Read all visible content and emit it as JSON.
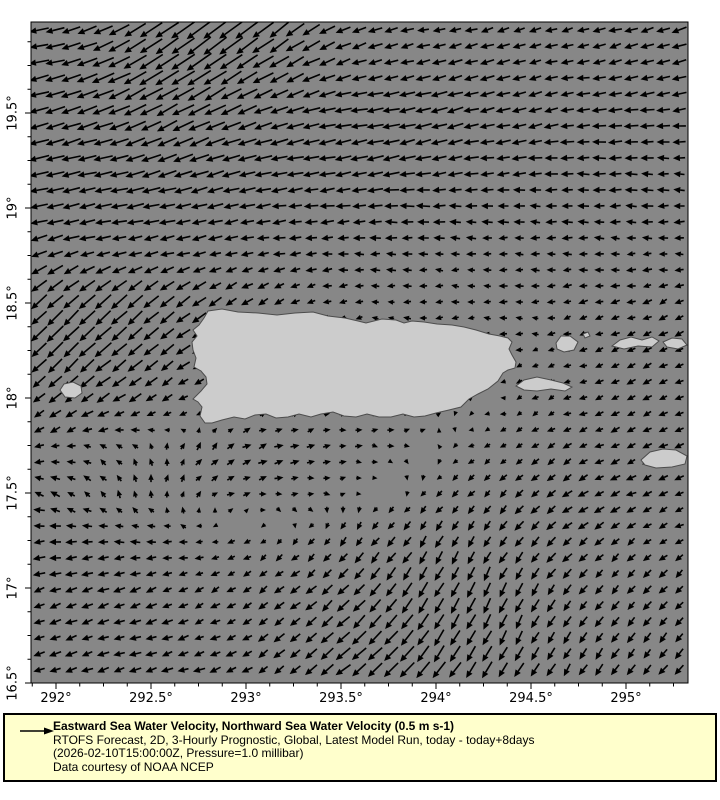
{
  "colors": {
    "page_bg": "#ffffff",
    "sea": "#878787",
    "land": "#cccccc",
    "land_outline": "#4d4d4d",
    "arrow": "#000000",
    "axis": "#000000",
    "legend_bg": "#ffffcc",
    "legend_border": "#000000"
  },
  "legend": {
    "reference_arrow_icon": "right-arrow",
    "title": "Eastward Sea Water Velocity, Northward Sea Water Velocity (0.5 m s-1)",
    "model": "RTOFS Forecast, 2D, 3-Hourly Prognostic, Global, Latest Model Run, today - today+8days",
    "time": "(2026-02-10T15:00:00Z, Pressure=1.0 millibar)",
    "credit": "Data courtesy of NOAA NCEP"
  },
  "chart_data": {
    "type": "quiver-map",
    "title": "Eastward Sea Water Velocity, Northward Sea Water Velocity",
    "reference_vector": "0.5 m s-1",
    "region": "Puerto Rico and Virgin Islands",
    "axes": {
      "x": {
        "unit": "degrees longitude (east)",
        "min": 291.868,
        "max": 295.326,
        "major_ticks": [
          292,
          292.5,
          293,
          293.5,
          294,
          294.5,
          295
        ],
        "major_labels": [
          "292°",
          "292.5°",
          "293°",
          "293.5°",
          "294°",
          "294.5°",
          "295°"
        ],
        "minor_step": 0.125
      },
      "y": {
        "unit": "degrees latitude (north)",
        "min": 16.5,
        "max": 19.979,
        "major_ticks": [
          16.5,
          17,
          17.5,
          18,
          18.5,
          19,
          19.5
        ],
        "major_labels": [
          "16.5°",
          "17°",
          "17.5°",
          "18°",
          "18.5°",
          "19°",
          "19.5°"
        ],
        "minor_step": 0.125
      }
    },
    "field": {
      "description": "Coarse sample of surface current vectors (u eastward, v northward, ~m/s); rendered grid interpolates bilinearly at 16 px spacing",
      "lons": [
        291.75,
        292.0,
        292.25,
        292.5,
        292.75,
        293.0,
        293.25,
        293.5,
        293.75,
        294.0,
        294.25,
        294.5,
        294.75,
        295.0,
        295.25
      ],
      "lats": [
        20.0,
        19.75,
        19.5,
        19.25,
        19.0,
        18.75,
        18.5,
        18.25,
        18.0,
        17.75,
        17.5,
        17.25,
        17.0,
        16.75,
        16.5
      ],
      "u": [
        [
          -0.55,
          -0.55,
          -0.6,
          -0.7,
          -0.8,
          -0.8,
          -0.6,
          -0.45,
          -0.35,
          -0.3,
          -0.3,
          -0.3,
          -0.3,
          -0.35,
          -0.4
        ],
        [
          -0.6,
          -0.6,
          -0.7,
          -0.8,
          -0.8,
          -0.7,
          -0.55,
          -0.45,
          -0.4,
          -0.4,
          -0.4,
          -0.35,
          -0.35,
          -0.35,
          -0.4
        ],
        [
          -0.6,
          -0.6,
          -0.65,
          -0.7,
          -0.7,
          -0.6,
          -0.55,
          -0.5,
          -0.5,
          -0.5,
          -0.45,
          -0.4,
          -0.4,
          -0.4,
          -0.4
        ],
        [
          -0.6,
          -0.6,
          -0.6,
          -0.6,
          -0.6,
          -0.55,
          -0.5,
          -0.5,
          -0.5,
          -0.45,
          -0.4,
          -0.4,
          -0.35,
          -0.35,
          -0.3
        ],
        [
          -0.5,
          -0.5,
          -0.5,
          -0.5,
          -0.45,
          -0.45,
          -0.4,
          -0.4,
          -0.4,
          -0.35,
          -0.3,
          -0.3,
          -0.3,
          -0.3,
          -0.3
        ],
        [
          -0.5,
          -0.45,
          -0.4,
          -0.4,
          -0.35,
          -0.3,
          -0.3,
          -0.25,
          -0.25,
          -0.2,
          -0.2,
          -0.2,
          -0.2,
          -0.2,
          -0.2
        ],
        [
          -0.5,
          -0.5,
          -0.5,
          -0.45,
          -0.4,
          -0.3,
          -0.2,
          -0.15,
          -0.15,
          -0.15,
          -0.15,
          -0.15,
          -0.2,
          -0.2,
          -0.2
        ],
        [
          -0.45,
          -0.5,
          -0.5,
          -0.45,
          -0.4,
          -0.1,
          -0.05,
          -0.05,
          -0.05,
          -0.05,
          -0.1,
          -0.1,
          -0.15,
          -0.2,
          -0.2
        ],
        [
          -0.3,
          -0.35,
          -0.4,
          -0.3,
          -0.2,
          -0.05,
          0.1,
          0.1,
          0.1,
          0.05,
          0.0,
          -0.1,
          -0.15,
          -0.2,
          -0.2
        ],
        [
          -0.2,
          -0.2,
          -0.15,
          -0.05,
          0.1,
          0.2,
          0.2,
          0.15,
          0.1,
          0.0,
          -0.1,
          -0.15,
          -0.2,
          -0.2,
          -0.2
        ],
        [
          -0.3,
          -0.2,
          -0.1,
          0.0,
          0.1,
          0.15,
          0.15,
          0.1,
          0.0,
          -0.1,
          -0.15,
          -0.2,
          -0.25,
          -0.25,
          -0.2
        ],
        [
          -0.3,
          -0.3,
          -0.25,
          -0.2,
          -0.15,
          -0.1,
          -0.1,
          -0.15,
          -0.2,
          -0.2,
          -0.2,
          -0.25,
          -0.25,
          -0.2,
          -0.2
        ],
        [
          -0.3,
          -0.3,
          -0.3,
          -0.25,
          -0.2,
          -0.2,
          -0.25,
          -0.3,
          -0.3,
          -0.25,
          -0.2,
          -0.2,
          -0.2,
          -0.2,
          -0.2
        ],
        [
          -0.3,
          -0.3,
          -0.3,
          -0.3,
          -0.25,
          -0.25,
          -0.3,
          -0.4,
          -0.4,
          -0.3,
          -0.25,
          -0.2,
          -0.2,
          -0.2,
          -0.2
        ],
        [
          -0.3,
          -0.3,
          -0.3,
          -0.3,
          -0.3,
          -0.25,
          -0.3,
          -0.45,
          -0.5,
          -0.4,
          -0.3,
          -0.25,
          -0.2,
          -0.2,
          -0.25
        ]
      ],
      "v": [
        [
          -0.05,
          -0.1,
          -0.25,
          -0.45,
          -0.6,
          -0.65,
          -0.45,
          -0.2,
          -0.1,
          -0.05,
          -0.1,
          -0.1,
          -0.1,
          -0.1,
          -0.15
        ],
        [
          -0.1,
          -0.15,
          -0.3,
          -0.5,
          -0.55,
          -0.45,
          -0.3,
          -0.15,
          -0.1,
          -0.1,
          -0.1,
          -0.1,
          -0.05,
          -0.1,
          -0.1
        ],
        [
          -0.15,
          -0.2,
          -0.25,
          -0.35,
          -0.35,
          -0.25,
          -0.15,
          -0.1,
          -0.1,
          -0.15,
          -0.1,
          -0.1,
          -0.05,
          -0.05,
          -0.05
        ],
        [
          -0.15,
          -0.15,
          -0.15,
          -0.2,
          -0.2,
          -0.15,
          -0.1,
          -0.1,
          -0.1,
          -0.1,
          -0.05,
          -0.05,
          0.0,
          0.0,
          0.0
        ],
        [
          -0.1,
          -0.1,
          -0.1,
          -0.1,
          -0.1,
          -0.1,
          -0.05,
          -0.05,
          0.0,
          0.0,
          0.0,
          0.0,
          0.0,
          0.0,
          0.0
        ],
        [
          -0.2,
          -0.15,
          -0.1,
          -0.1,
          -0.1,
          -0.05,
          -0.05,
          0.0,
          0.0,
          0.0,
          0.0,
          0.0,
          0.0,
          0.0,
          0.0
        ],
        [
          -0.4,
          -0.45,
          -0.45,
          -0.4,
          -0.3,
          -0.2,
          -0.1,
          -0.05,
          0.0,
          0.0,
          0.0,
          0.0,
          -0.05,
          -0.05,
          -0.1
        ],
        [
          -0.4,
          -0.5,
          -0.45,
          -0.35,
          -0.2,
          -0.05,
          0.0,
          0.0,
          0.0,
          0.0,
          0.0,
          0.0,
          -0.05,
          -0.1,
          -0.1
        ],
        [
          -0.25,
          -0.3,
          -0.25,
          -0.2,
          -0.1,
          0.0,
          0.05,
          0.05,
          0.0,
          0.0,
          0.0,
          -0.05,
          -0.05,
          -0.1,
          -0.1
        ],
        [
          -0.1,
          -0.05,
          0.05,
          0.1,
          0.15,
          0.1,
          0.05,
          0.0,
          0.0,
          0.0,
          -0.05,
          -0.1,
          -0.1,
          -0.1,
          -0.1
        ],
        [
          0.0,
          0.1,
          0.15,
          0.15,
          0.1,
          0.05,
          0.0,
          0.0,
          0.0,
          -0.1,
          -0.15,
          -0.2,
          -0.15,
          -0.1,
          -0.1
        ],
        [
          -0.05,
          0.0,
          0.0,
          0.0,
          0.0,
          -0.05,
          -0.1,
          -0.2,
          -0.25,
          -0.3,
          -0.3,
          -0.25,
          -0.2,
          -0.15,
          -0.1
        ],
        [
          -0.1,
          -0.1,
          -0.1,
          -0.1,
          -0.1,
          -0.15,
          -0.2,
          -0.3,
          -0.4,
          -0.45,
          -0.45,
          -0.35,
          -0.25,
          -0.2,
          -0.2
        ],
        [
          -0.1,
          -0.1,
          -0.1,
          -0.1,
          -0.1,
          -0.15,
          -0.25,
          -0.35,
          -0.45,
          -0.5,
          -0.45,
          -0.35,
          -0.3,
          -0.25,
          -0.25
        ],
        [
          -0.1,
          -0.1,
          -0.1,
          -0.1,
          -0.1,
          -0.15,
          -0.25,
          -0.35,
          -0.45,
          -0.5,
          -0.5,
          -0.4,
          -0.3,
          -0.3,
          -0.3
        ]
      ]
    },
    "land": {
      "islands": [
        {
          "name": "puerto-rico",
          "points": [
            [
              208,
              311
            ],
            [
              222,
              309
            ],
            [
              238,
              312
            ],
            [
              258,
              313
            ],
            [
              277,
              315
            ],
            [
              295,
              313
            ],
            [
              313,
              312
            ],
            [
              328,
              316
            ],
            [
              345,
              318
            ],
            [
              358,
              321
            ],
            [
              366,
              323
            ],
            [
              382,
              319
            ],
            [
              396,
              320
            ],
            [
              404,
              323
            ],
            [
              412,
              321
            ],
            [
              424,
              322
            ],
            [
              437,
              324
            ],
            [
              452,
              325
            ],
            [
              464,
              327
            ],
            [
              476,
              330
            ],
            [
              489,
              334
            ],
            [
              500,
              336
            ],
            [
              508,
              338
            ],
            [
              512,
              342
            ],
            [
              509,
              349
            ],
            [
              512,
              355
            ],
            [
              516,
              362
            ],
            [
              515,
              368
            ],
            [
              508,
              370
            ],
            [
              503,
              373
            ],
            [
              498,
              381
            ],
            [
              488,
              389
            ],
            [
              478,
              394
            ],
            [
              469,
              399
            ],
            [
              461,
              407
            ],
            [
              449,
              410
            ],
            [
              436,
              413
            ],
            [
              425,
              416
            ],
            [
              414,
              417
            ],
            [
              403,
              414
            ],
            [
              391,
              417
            ],
            [
              379,
              417
            ],
            [
              367,
              414
            ],
            [
              356,
              417
            ],
            [
              344,
              416
            ],
            [
              333,
              412
            ],
            [
              321,
              414
            ],
            [
              311,
              417
            ],
            [
              299,
              414
            ],
            [
              288,
              417
            ],
            [
              276,
              418
            ],
            [
              266,
              414
            ],
            [
              255,
              415
            ],
            [
              245,
              419
            ],
            [
              234,
              417
            ],
            [
              222,
              420
            ],
            [
              212,
              423
            ],
            [
              205,
              423
            ],
            [
              200,
              416
            ],
            [
              202,
              407
            ],
            [
              198,
              402
            ],
            [
              193,
              399
            ],
            [
              201,
              391
            ],
            [
              207,
              384
            ],
            [
              206,
              377
            ],
            [
              201,
              371
            ],
            [
              194,
              367
            ],
            [
              196,
              358
            ],
            [
              193,
              350
            ],
            [
              192,
              342
            ],
            [
              197,
              336
            ],
            [
              193,
              330
            ],
            [
              199,
              325
            ],
            [
              204,
              318
            ]
          ]
        },
        {
          "name": "mona",
          "points": [
            [
              60,
              390
            ],
            [
              64,
              384
            ],
            [
              73,
              382
            ],
            [
              81,
              386
            ],
            [
              82,
              393
            ],
            [
              75,
              398
            ],
            [
              65,
              397
            ]
          ]
        },
        {
          "name": "vieques",
          "points": [
            [
              516,
              386
            ],
            [
              524,
              380
            ],
            [
              537,
              377
            ],
            [
              551,
              380
            ],
            [
              563,
              383
            ],
            [
              572,
              387
            ],
            [
              565,
              391
            ],
            [
              551,
              389
            ],
            [
              537,
              391
            ],
            [
              524,
              390
            ]
          ]
        },
        {
          "name": "culebra",
          "points": [
            [
              556,
              343
            ],
            [
              561,
              336
            ],
            [
              570,
              336
            ],
            [
              578,
              342
            ],
            [
              574,
              350
            ],
            [
              564,
              352
            ],
            [
              557,
              349
            ]
          ]
        },
        {
          "name": "culebrita",
          "points": [
            [
              583,
              334
            ],
            [
              588,
              332
            ],
            [
              590,
              336
            ],
            [
              585,
              338
            ]
          ]
        },
        {
          "name": "st-thomas",
          "points": [
            [
              612,
              346
            ],
            [
              620,
              340
            ],
            [
              631,
              337
            ],
            [
              642,
              340
            ],
            [
              652,
              337
            ],
            [
              659,
              341
            ],
            [
              652,
              347
            ],
            [
              638,
              346
            ],
            [
              624,
              349
            ]
          ]
        },
        {
          "name": "st-john-tortola",
          "points": [
            [
              663,
              342
            ],
            [
              672,
              338
            ],
            [
              682,
              339
            ],
            [
              687,
              345
            ],
            [
              678,
              349
            ],
            [
              667,
              347
            ]
          ]
        },
        {
          "name": "st-croix",
          "points": [
            [
              641,
              460
            ],
            [
              650,
              452
            ],
            [
              663,
              449
            ],
            [
              676,
              450
            ],
            [
              687,
              456
            ],
            [
              685,
              464
            ],
            [
              672,
              467
            ],
            [
              656,
              468
            ],
            [
              645,
              465
            ]
          ]
        }
      ]
    }
  }
}
